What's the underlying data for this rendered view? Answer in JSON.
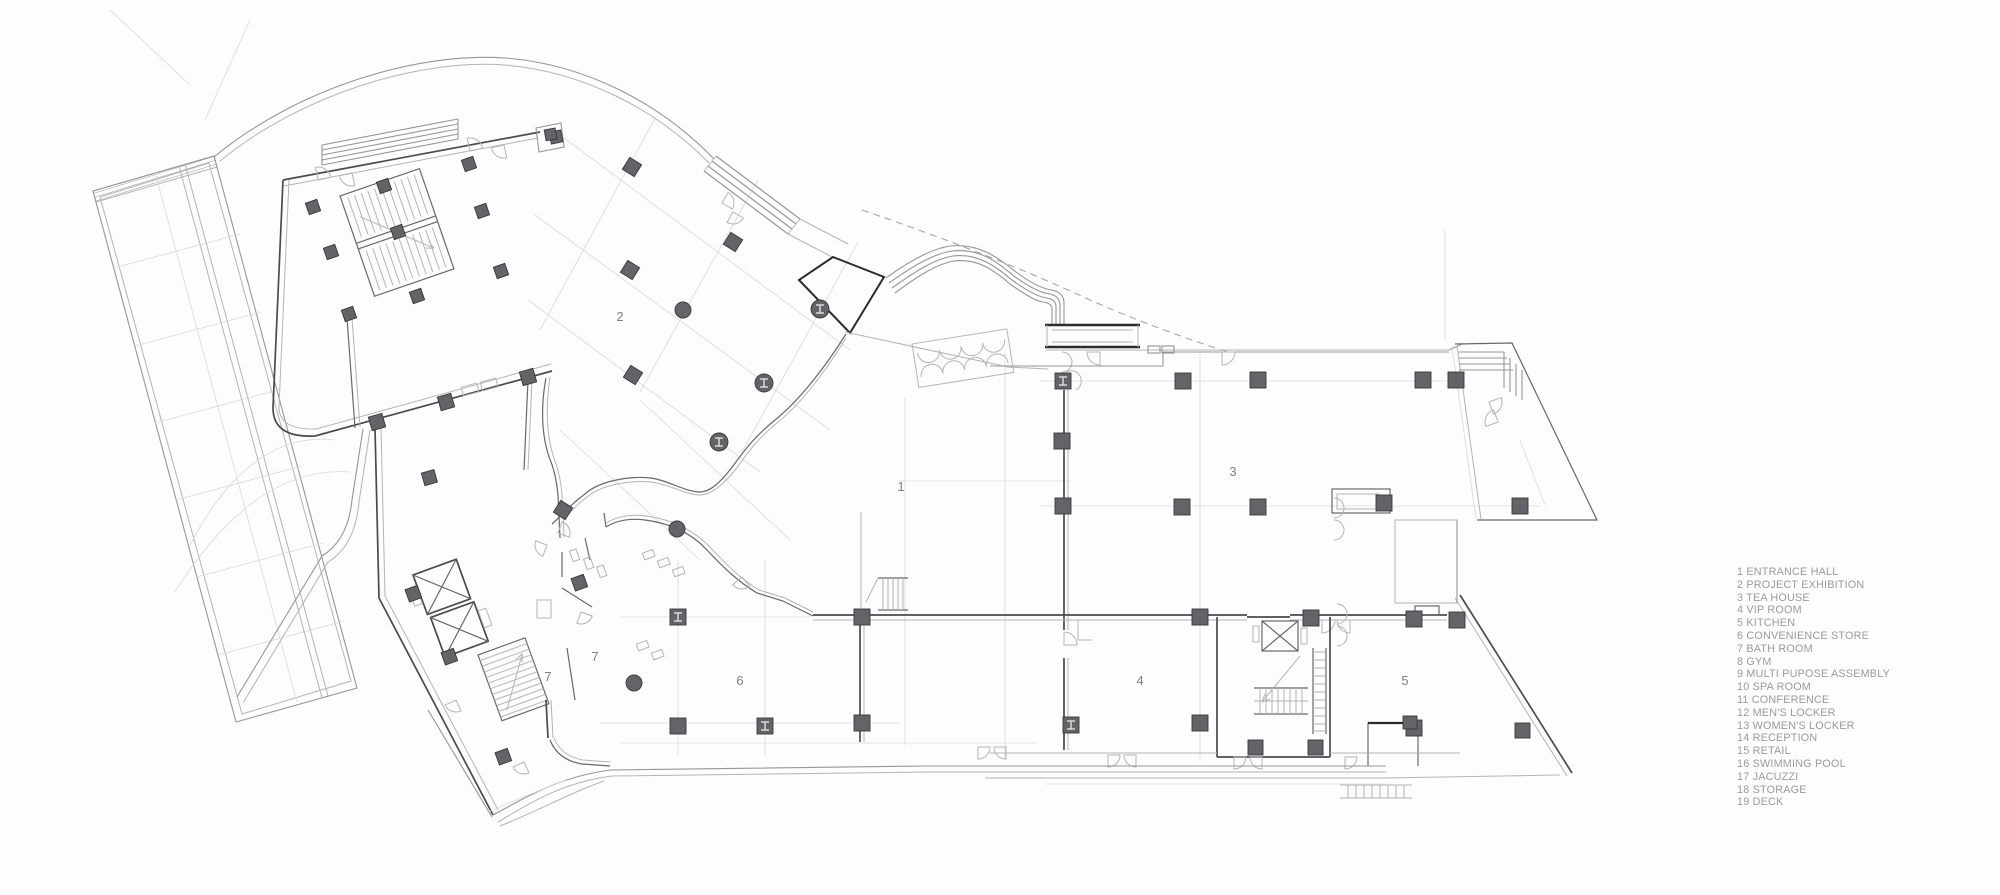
{
  "document": {
    "kind": "architectural floor plan drawing",
    "background": "#fdfdfd",
    "ink_dark": "#2b2b2f",
    "ink_mid": "#68686c",
    "ink_light": "#b4b4b8",
    "label_color": "#7f7f83",
    "legend_color": "#9a9a9e"
  },
  "room_labels": [
    {
      "text": "1",
      "room": "entrance hall"
    },
    {
      "text": "2",
      "room": "project exhibition"
    },
    {
      "text": "3",
      "room": "tea house"
    },
    {
      "text": "4",
      "room": "vip room"
    },
    {
      "text": "5",
      "room": "kitchen"
    },
    {
      "text": "6",
      "room": "convenience store"
    },
    {
      "text": "7",
      "room": "bath room"
    },
    {
      "text": "7",
      "room": "bath room"
    }
  ],
  "legend": {
    "items": [
      "1 ENTRANCE HALL",
      "2 PROJECT EXHIBITION",
      "3 TEA HOUSE",
      "4 VIP ROOM",
      "5 KITCHEN",
      "6 CONVENIENCE STORE",
      "7 BATH ROOM",
      "8 GYM",
      "9 MULTI PUPOSE ASSEMBLY",
      "10 SPA ROOM",
      "11 CONFERENCE",
      "12 MEN'S LOCKER",
      "13 WOMEN'S LOCKER",
      "14 RECEPTION",
      "15 RETAIL",
      "16 SWIMMING POOL",
      "17 JACUZZI",
      "18 STORAGE",
      "19 DECK"
    ]
  }
}
